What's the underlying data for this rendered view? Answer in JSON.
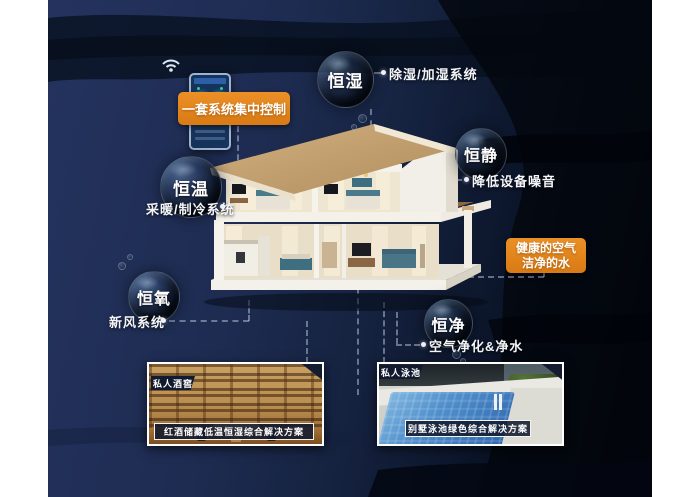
{
  "colors": {
    "page_bg": "#ffffff",
    "canvas_navy": "#1e2c52",
    "canvas_dark": "#05080f",
    "accent_orange": "#e0821b",
    "text": "#ffffff"
  },
  "controller": {
    "device_icon": "smart-home-control-panel",
    "wifi_icon": "wifi",
    "label": "一套系统集中控制"
  },
  "bubbles": [
    {
      "label": "恒湿",
      "note": "除湿/加湿系统"
    },
    {
      "label": "恒静",
      "note": "降低设备噪音"
    },
    {
      "label": "恒温",
      "note": "采暖/制冷系统"
    },
    {
      "label": "恒氧",
      "note": "新风系统"
    },
    {
      "label": "恒净",
      "note": "空气净化&净水"
    }
  ],
  "highlight_box": {
    "line1": "健康的空气",
    "line2": "洁净的水"
  },
  "house": {
    "illustration": "two-story-villa-cutaway"
  },
  "cards": [
    {
      "badge": "私人酒窖",
      "caption": "红酒储藏低温恒湿综合解决方案",
      "photo": "wine-cellar"
    },
    {
      "badge": "私人泳池",
      "caption": "别墅泳池绿色综合解决方案",
      "photo": "villa-swimming-pool"
    }
  ]
}
